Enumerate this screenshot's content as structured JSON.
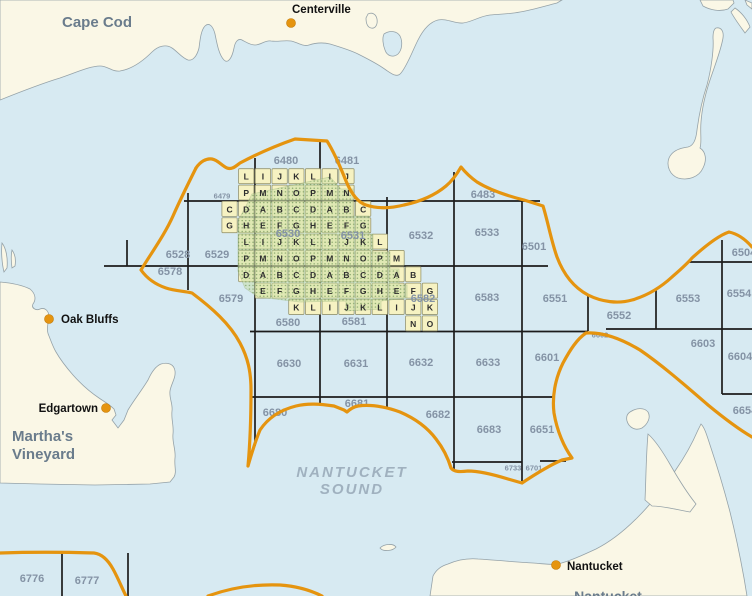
{
  "map": {
    "title": "Nantucket Sound lease block map",
    "colors": {
      "water": "#d7eaf2",
      "land": "#faf7e6",
      "coast": "#95a2a8",
      "grid_line": "#1c1c1c",
      "tile_fill": "#f6f2c2",
      "tile_stroke": "#97966f",
      "highlight_green": "#c9dfa6",
      "highlight_dot": "#74985a",
      "boundary_orange": "#e5940f",
      "block_label": "#8493a5",
      "cell_letter": "#2f2f2f",
      "town_label": "#111111",
      "region_label": "#6a7c8c",
      "sound_label": "#a0b1bf",
      "town_dot": "#e5940f"
    },
    "region_labels": [
      {
        "text": "Cape Cod",
        "x": 97,
        "y": 27,
        "size": 15,
        "anchor": "middle",
        "italic": false,
        "spacing": 0,
        "name": "cape-cod"
      },
      {
        "text": "Martha's",
        "x": 12,
        "y": 441,
        "size": 15,
        "anchor": "start",
        "italic": false,
        "spacing": 0,
        "name": "marthas"
      },
      {
        "text": "Vineyard",
        "x": 12,
        "y": 459,
        "size": 15,
        "anchor": "start",
        "italic": false,
        "spacing": 0,
        "name": "vineyard"
      },
      {
        "text": "NANTUCKET",
        "x": 352,
        "y": 477,
        "size": 15,
        "anchor": "middle",
        "italic": true,
        "spacing": 2,
        "name": "nantucket-sound-1"
      },
      {
        "text": "SOUND",
        "x": 352,
        "y": 494,
        "size": 15,
        "anchor": "middle",
        "italic": true,
        "spacing": 2,
        "name": "nantucket-sound-2"
      },
      {
        "text": "Nantucket",
        "x": 608,
        "y": 601,
        "size": 14,
        "anchor": "middle",
        "italic": false,
        "spacing": 0,
        "name": "nantucket-island"
      }
    ],
    "towns": [
      {
        "name": "Centerville",
        "dot_x": 291,
        "dot_y": 23,
        "label_x": 292,
        "label_y": 13,
        "anchor": "start"
      },
      {
        "name": "Oak Bluffs",
        "dot_x": 49,
        "dot_y": 319,
        "label_x": 61,
        "label_y": 323,
        "anchor": "start"
      },
      {
        "name": "Edgartown",
        "dot_x": 106,
        "dot_y": 408,
        "label_x": 98,
        "label_y": 412,
        "anchor": "end"
      },
      {
        "name": "Nantucket",
        "dot_x": 556,
        "dot_y": 565,
        "label_x": 567,
        "label_y": 570,
        "anchor": "start"
      }
    ],
    "block_labels": [
      {
        "t": "6479",
        "x": 222,
        "y": 196,
        "s": 7.5
      },
      {
        "t": "6480",
        "x": 286,
        "y": 161,
        "s": 11
      },
      {
        "t": "6481",
        "x": 347,
        "y": 161,
        "s": 11
      },
      {
        "t": "6483",
        "x": 483,
        "y": 195,
        "s": 11
      },
      {
        "t": "6501",
        "x": 534,
        "y": 247,
        "s": 11
      },
      {
        "t": "6504",
        "x": 744,
        "y": 253,
        "s": 11
      },
      {
        "t": "6528",
        "x": 178,
        "y": 255,
        "s": 11
      },
      {
        "t": "6529",
        "x": 217,
        "y": 255,
        "s": 11
      },
      {
        "t": "6530",
        "x": 288,
        "y": 234,
        "s": 11
      },
      {
        "t": "6531",
        "x": 353,
        "y": 236,
        "s": 11
      },
      {
        "t": "6532",
        "x": 421,
        "y": 236,
        "s": 11
      },
      {
        "t": "6533",
        "x": 487,
        "y": 233,
        "s": 11
      },
      {
        "t": "6551",
        "x": 555,
        "y": 299,
        "s": 11
      },
      {
        "t": "6552",
        "x": 619,
        "y": 316,
        "s": 11
      },
      {
        "t": "6553",
        "x": 688,
        "y": 299,
        "s": 11
      },
      {
        "t": "6554",
        "x": 739,
        "y": 294,
        "s": 11
      },
      {
        "t": "6578",
        "x": 170,
        "y": 272,
        "s": 11
      },
      {
        "t": "6579",
        "x": 231,
        "y": 299,
        "s": 11
      },
      {
        "t": "6580",
        "x": 288,
        "y": 323,
        "s": 11
      },
      {
        "t": "6581",
        "x": 354,
        "y": 322,
        "s": 11
      },
      {
        "t": "6582",
        "x": 423,
        "y": 299,
        "s": 11
      },
      {
        "t": "6583",
        "x": 487,
        "y": 298,
        "s": 11
      },
      {
        "t": "6601",
        "x": 547,
        "y": 358,
        "s": 11
      },
      {
        "t": "6602",
        "x": 600,
        "y": 335,
        "s": 7.5
      },
      {
        "t": "6603",
        "x": 703,
        "y": 344,
        "s": 11
      },
      {
        "t": "6604",
        "x": 740,
        "y": 357,
        "s": 11
      },
      {
        "t": "6630",
        "x": 289,
        "y": 364,
        "s": 11
      },
      {
        "t": "6631",
        "x": 356,
        "y": 364,
        "s": 11
      },
      {
        "t": "6632",
        "x": 421,
        "y": 363,
        "s": 11
      },
      {
        "t": "6633",
        "x": 488,
        "y": 363,
        "s": 11
      },
      {
        "t": "6651",
        "x": 542,
        "y": 430,
        "s": 11
      },
      {
        "t": "6654",
        "x": 745,
        "y": 411,
        "s": 11
      },
      {
        "t": "6680",
        "x": 275,
        "y": 413,
        "s": 11
      },
      {
        "t": "6681",
        "x": 357,
        "y": 404,
        "s": 11
      },
      {
        "t": "6682",
        "x": 438,
        "y": 415,
        "s": 11
      },
      {
        "t": "6683",
        "x": 489,
        "y": 430,
        "s": 11
      },
      {
        "t": "6701",
        "x": 534,
        "y": 468,
        "s": 7.5
      },
      {
        "t": "6733",
        "x": 513,
        "y": 468,
        "s": 7.5
      },
      {
        "t": "6776",
        "x": 32,
        "y": 579,
        "s": 11
      },
      {
        "t": "6777",
        "x": 87,
        "y": 581,
        "s": 11
      }
    ],
    "cells": {
      "x0": 254.6,
      "y0": 168,
      "cw": 16.7,
      "ch": 16.35,
      "items": [
        [
          -1,
          0,
          "L"
        ],
        [
          0,
          0,
          "I"
        ],
        [
          1,
          0,
          "J"
        ],
        [
          2,
          0,
          "K"
        ],
        [
          3,
          0,
          "L"
        ],
        [
          4,
          0,
          "I"
        ],
        [
          5,
          0,
          "J"
        ],
        [
          -1,
          1,
          "P"
        ],
        [
          0,
          1,
          "M"
        ],
        [
          1,
          1,
          "N"
        ],
        [
          2,
          1,
          "O"
        ],
        [
          3,
          1,
          "P"
        ],
        [
          4,
          1,
          "M"
        ],
        [
          5,
          1,
          "N"
        ],
        [
          -2,
          2,
          "C"
        ],
        [
          -1,
          2,
          "D"
        ],
        [
          0,
          2,
          "A"
        ],
        [
          1,
          2,
          "B"
        ],
        [
          2,
          2,
          "C"
        ],
        [
          3,
          2,
          "D"
        ],
        [
          4,
          2,
          "A"
        ],
        [
          5,
          2,
          "B"
        ],
        [
          6,
          2,
          "C"
        ],
        [
          -2,
          3,
          "G"
        ],
        [
          -1,
          3,
          "H"
        ],
        [
          0,
          3,
          "E"
        ],
        [
          1,
          3,
          "F"
        ],
        [
          2,
          3,
          "G"
        ],
        [
          3,
          3,
          "H"
        ],
        [
          4,
          3,
          "E"
        ],
        [
          5,
          3,
          "F"
        ],
        [
          6,
          3,
          "G"
        ],
        [
          -1,
          4,
          "L"
        ],
        [
          0,
          4,
          "I"
        ],
        [
          1,
          4,
          "J"
        ],
        [
          2,
          4,
          "K"
        ],
        [
          3,
          4,
          "L"
        ],
        [
          4,
          4,
          "I"
        ],
        [
          5,
          4,
          "J"
        ],
        [
          6,
          4,
          "K"
        ],
        [
          7,
          4,
          "L"
        ],
        [
          -1,
          5,
          "P"
        ],
        [
          0,
          5,
          "M"
        ],
        [
          1,
          5,
          "N"
        ],
        [
          2,
          5,
          "O"
        ],
        [
          3,
          5,
          "P"
        ],
        [
          4,
          5,
          "M"
        ],
        [
          5,
          5,
          "N"
        ],
        [
          6,
          5,
          "O"
        ],
        [
          7,
          5,
          "P"
        ],
        [
          8,
          5,
          "M"
        ],
        [
          -1,
          6,
          "D"
        ],
        [
          0,
          6,
          "A"
        ],
        [
          1,
          6,
          "B"
        ],
        [
          2,
          6,
          "C"
        ],
        [
          3,
          6,
          "D"
        ],
        [
          4,
          6,
          "A"
        ],
        [
          5,
          6,
          "B"
        ],
        [
          6,
          6,
          "C"
        ],
        [
          7,
          6,
          "D"
        ],
        [
          8,
          6,
          "A"
        ],
        [
          9,
          6,
          "B"
        ],
        [
          0,
          7,
          "E"
        ],
        [
          1,
          7,
          "F"
        ],
        [
          2,
          7,
          "G"
        ],
        [
          3,
          7,
          "H"
        ],
        [
          4,
          7,
          "E"
        ],
        [
          5,
          7,
          "F"
        ],
        [
          6,
          7,
          "G"
        ],
        [
          7,
          7,
          "H"
        ],
        [
          8,
          7,
          "E"
        ],
        [
          9,
          7,
          "F"
        ],
        [
          10,
          7,
          "G"
        ],
        [
          2,
          8,
          "K"
        ],
        [
          3,
          8,
          "L"
        ],
        [
          4,
          8,
          "I"
        ],
        [
          5,
          8,
          "J"
        ],
        [
          6,
          8,
          "K"
        ],
        [
          7,
          8,
          "L"
        ],
        [
          8,
          8,
          "I"
        ],
        [
          9,
          8,
          "J"
        ],
        [
          10,
          8,
          "K"
        ],
        [
          9,
          9,
          "N"
        ],
        [
          10,
          9,
          "O"
        ]
      ]
    },
    "grid": {
      "h": [
        {
          "y": 201,
          "x1": 184,
          "x2": 540
        },
        {
          "y": 266,
          "x1": 104,
          "x2": 548
        },
        {
          "y": 331.5,
          "x1": 250,
          "x2": 588
        },
        {
          "y": 329,
          "x1": 606,
          "x2": 752
        },
        {
          "y": 397,
          "x1": 252,
          "x2": 554
        },
        {
          "y": 394,
          "x1": 722,
          "x2": 752
        },
        {
          "y": 462,
          "x1": 452,
          "x2": 522
        },
        {
          "y": 461,
          "x1": 540,
          "x2": 566
        },
        {
          "y": 262,
          "x1": 688,
          "x2": 752
        }
      ],
      "v": [
        {
          "x": 127,
          "y1": 240,
          "y2": 266
        },
        {
          "x": 188,
          "y1": 193,
          "y2": 290
        },
        {
          "x": 255,
          "y1": 158,
          "y2": 446
        },
        {
          "x": 320,
          "y1": 141,
          "y2": 404
        },
        {
          "x": 387,
          "y1": 197,
          "y2": 407
        },
        {
          "x": 454,
          "y1": 172,
          "y2": 470
        },
        {
          "x": 522,
          "y1": 200,
          "y2": 481
        },
        {
          "x": 588,
          "y1": 296,
          "y2": 331
        },
        {
          "x": 656,
          "y1": 288,
          "y2": 329
        },
        {
          "x": 722,
          "y1": 240,
          "y2": 394
        },
        {
          "x": 62,
          "y1": 553,
          "y2": 596
        },
        {
          "x": 128,
          "y1": 553,
          "y2": 596
        }
      ]
    },
    "highlight_polygon": "252,194 330,177 341,189 353,189 353,216 369,216 369,234 373,234 373,252 390,252 390,269 399,269 399,285 407,285 407,298 381,301 381,309 346,311 346,301 300,302 258,297 245,288 238,271 238,221 246,206",
    "geometry": {
      "land_paths": [
        "M 0,100 C 20,92 40,84 60,78 C 75,73 90,66 100,66 C 108,66 112,72 120,71 C 132,69 142,62 152,52 C 158,46 166,44 172,48 C 178,52 182,58 188,60 C 193,61 197,56 199,48 C 200,40 201,30 205,26 C 209,22 213,26 215,34 C 217,44 219,55 224,60 C 228,64 232,58 234,48 C 235,42 238,38 242,40 C 246,42 250,45 255,45 C 261,45 265,40 271,41 C 278,42 284,40 291,41 C 297,42 303,47 309,45 C 315,43 322,42 330,44 C 340,47 350,50 358,54 C 368,59 378,64 386,70 C 392,74 397,78 401,73 C 407,66 412,52 418,40 C 423,30 430,22 438,20 C 447,18 455,24 463,23 C 472,22 480,16 490,15 C 500,14 510,14 520,12 C 532,10 545,6 557,3 L 562,0 L 0,0 Z",
        "M 368,14 C 372,12 376,14 377,19 C 378,25 375,29 371,28 C 367,27 366,22 366,18 Z",
        "M 716,28 C 721,27 724,31 723,38 C 721,50 716,62 710,80 C 705,95 702,108 701,122 C 700,134 702,142 700,148 C 706,152 707,160 703,168 C 699,177 688,181 678,178 C 670,175 666,166 669,158 C 672,151 680,148 688,147 C 693,146 696,140 697,130 C 699,115 702,100 707,85 C 711,70 714,50 713,38 C 713,32 714,29 716,28 Z",
        "M 700,0 L 703,6 C 710,10 720,12 728,9 L 734,3 L 733,0 Z",
        "M 735,8 C 741,12 747,19 750,27 L 745,33 C 740,26 734,18 731,12 Z",
        "M 745,0 L 752,3 L 752,9 L 747,5 Z",
        "M 0,282 C 12,283 22,285 30,289 C 36,294 36,300 33,304 C 31,308 36,311 40,309 C 45,307 49,311 49,317 C 48,324 46,330 49,336 C 51,341 53,347 56,352 C 60,359 66,367 73,375 C 81,384 90,392 99,398 C 105,402 110,405 114,409 L 116,415 L 112,420 L 118,428 L 124,420 L 128,410 C 134,400 142,390 148,380 C 152,371 156,366 161,364 C 168,362 174,364 175,371 C 176,378 171,384 170,391 C 169,398 173,404 172,411 C 171,419 174,426 173,434 C 172,442 176,450 175,458 C 174,466 177,472 174,477 L 170,482 L 150,484 L 95,485 L 40,484 L 0,483 Z",
        "M 2,243 C 6,248 8,258 7,268 L 4,272 C 2,264 1,252 2,243 Z",
        "M 12,250 C 15,254 16,260 15,266 L 12,268 C 11,261 11,255 12,250 Z",
        "M 430,596 L 433,576 C 436,570 441,566 448,564 C 455,561 466,558 478,559 C 495,560 515,562 533,563 C 546,564 552,565 558,564 C 570,561 583,555 596,549 C 610,542 624,531 637,518 C 650,505 663,489 675,471 C 684,458 692,444 698,430 L 701,424 C 705,428 707,436 711,448 C 717,466 724,489 730,512 C 735,532 740,556 744,578 L 747,596 Z",
        "M 648,434 C 655,440 663,452 671,466 C 679,480 688,494 696,504 L 690,512 C 678,510 664,506 652,506 L 645,500 C 646,480 646,456 648,434 Z",
        "M 630,412 C 636,408 644,407 648,412 C 651,417 648,424 642,428 C 636,431 629,428 627,421 C 626,417 627,414 630,412 Z",
        "M 380,548 C 384,544 393,543 396,547 C 393,551 383,552 380,548 Z"
      ],
      "water_feature_paths": [
        "M 384,34 C 390,30 397,31 400,36 C 403,42 402,50 398,54 C 393,58 387,56 385,50 C 383,45 382,38 384,34 Z"
      ],
      "orange_paths": [
        "M 196,168 C 188,184 180,200 173,216 C 165,234 152,252 141,270 C 146,277 154,284 166,288 C 175,291 184,291 192,293 C 212,308 230,324 240,343 C 248,358 251,372 251,390 C 251,416 250,444 248,466 C 252,452 255,442 260,430 C 268,418 280,410 296,406 C 308,403 320,404 334,406 L 344,410 L 347,412 C 350,409 353,407 358,406 C 372,404 386,407 400,412 C 414,418 427,427 436,439 C 443,448 448,458 451,468 C 454,472 460,472 468,471 C 480,471 495,475 508,479 L 522,483 C 534,475 548,466 562,460 L 572,458 C 564,447 557,431 554,413 C 552,397 555,379 563,363 C 570,350 577,339 586,333 C 602,332 620,338 640,350 C 662,365 686,386 708,405 C 725,419 740,430 752,437",
        "M 196,168 C 200,162 206,158 212,159 C 218,160 222,166 227,168 C 232,170 236,166 240,163 C 255,155 275,146 295,139 L 327,141 C 334,152 340,166 346,181 C 351,193 357,202 366,205 C 378,209 392,208 404,205 C 418,202 434,196 446,186 C 452,181 457,174 461,167 C 465,172 470,177 477,182 C 490,190 508,196 524,200 L 543,206 C 548,222 551,240 557,257 C 563,273 573,287 588,295 C 602,302 618,304 632,300 C 646,296 660,288 672,277 C 680,270 687,264 692,258 C 703,248 717,236 729,232 C 738,234 746,240 752,247",
        "M 0,553 C 30,552 60,552 94,553 C 102,554 108,560 113,569 C 118,578 122,588 126,596",
        "M 208,596 C 230,588 255,584 280,585 C 295,586 310,590 322,596"
      ]
    }
  }
}
